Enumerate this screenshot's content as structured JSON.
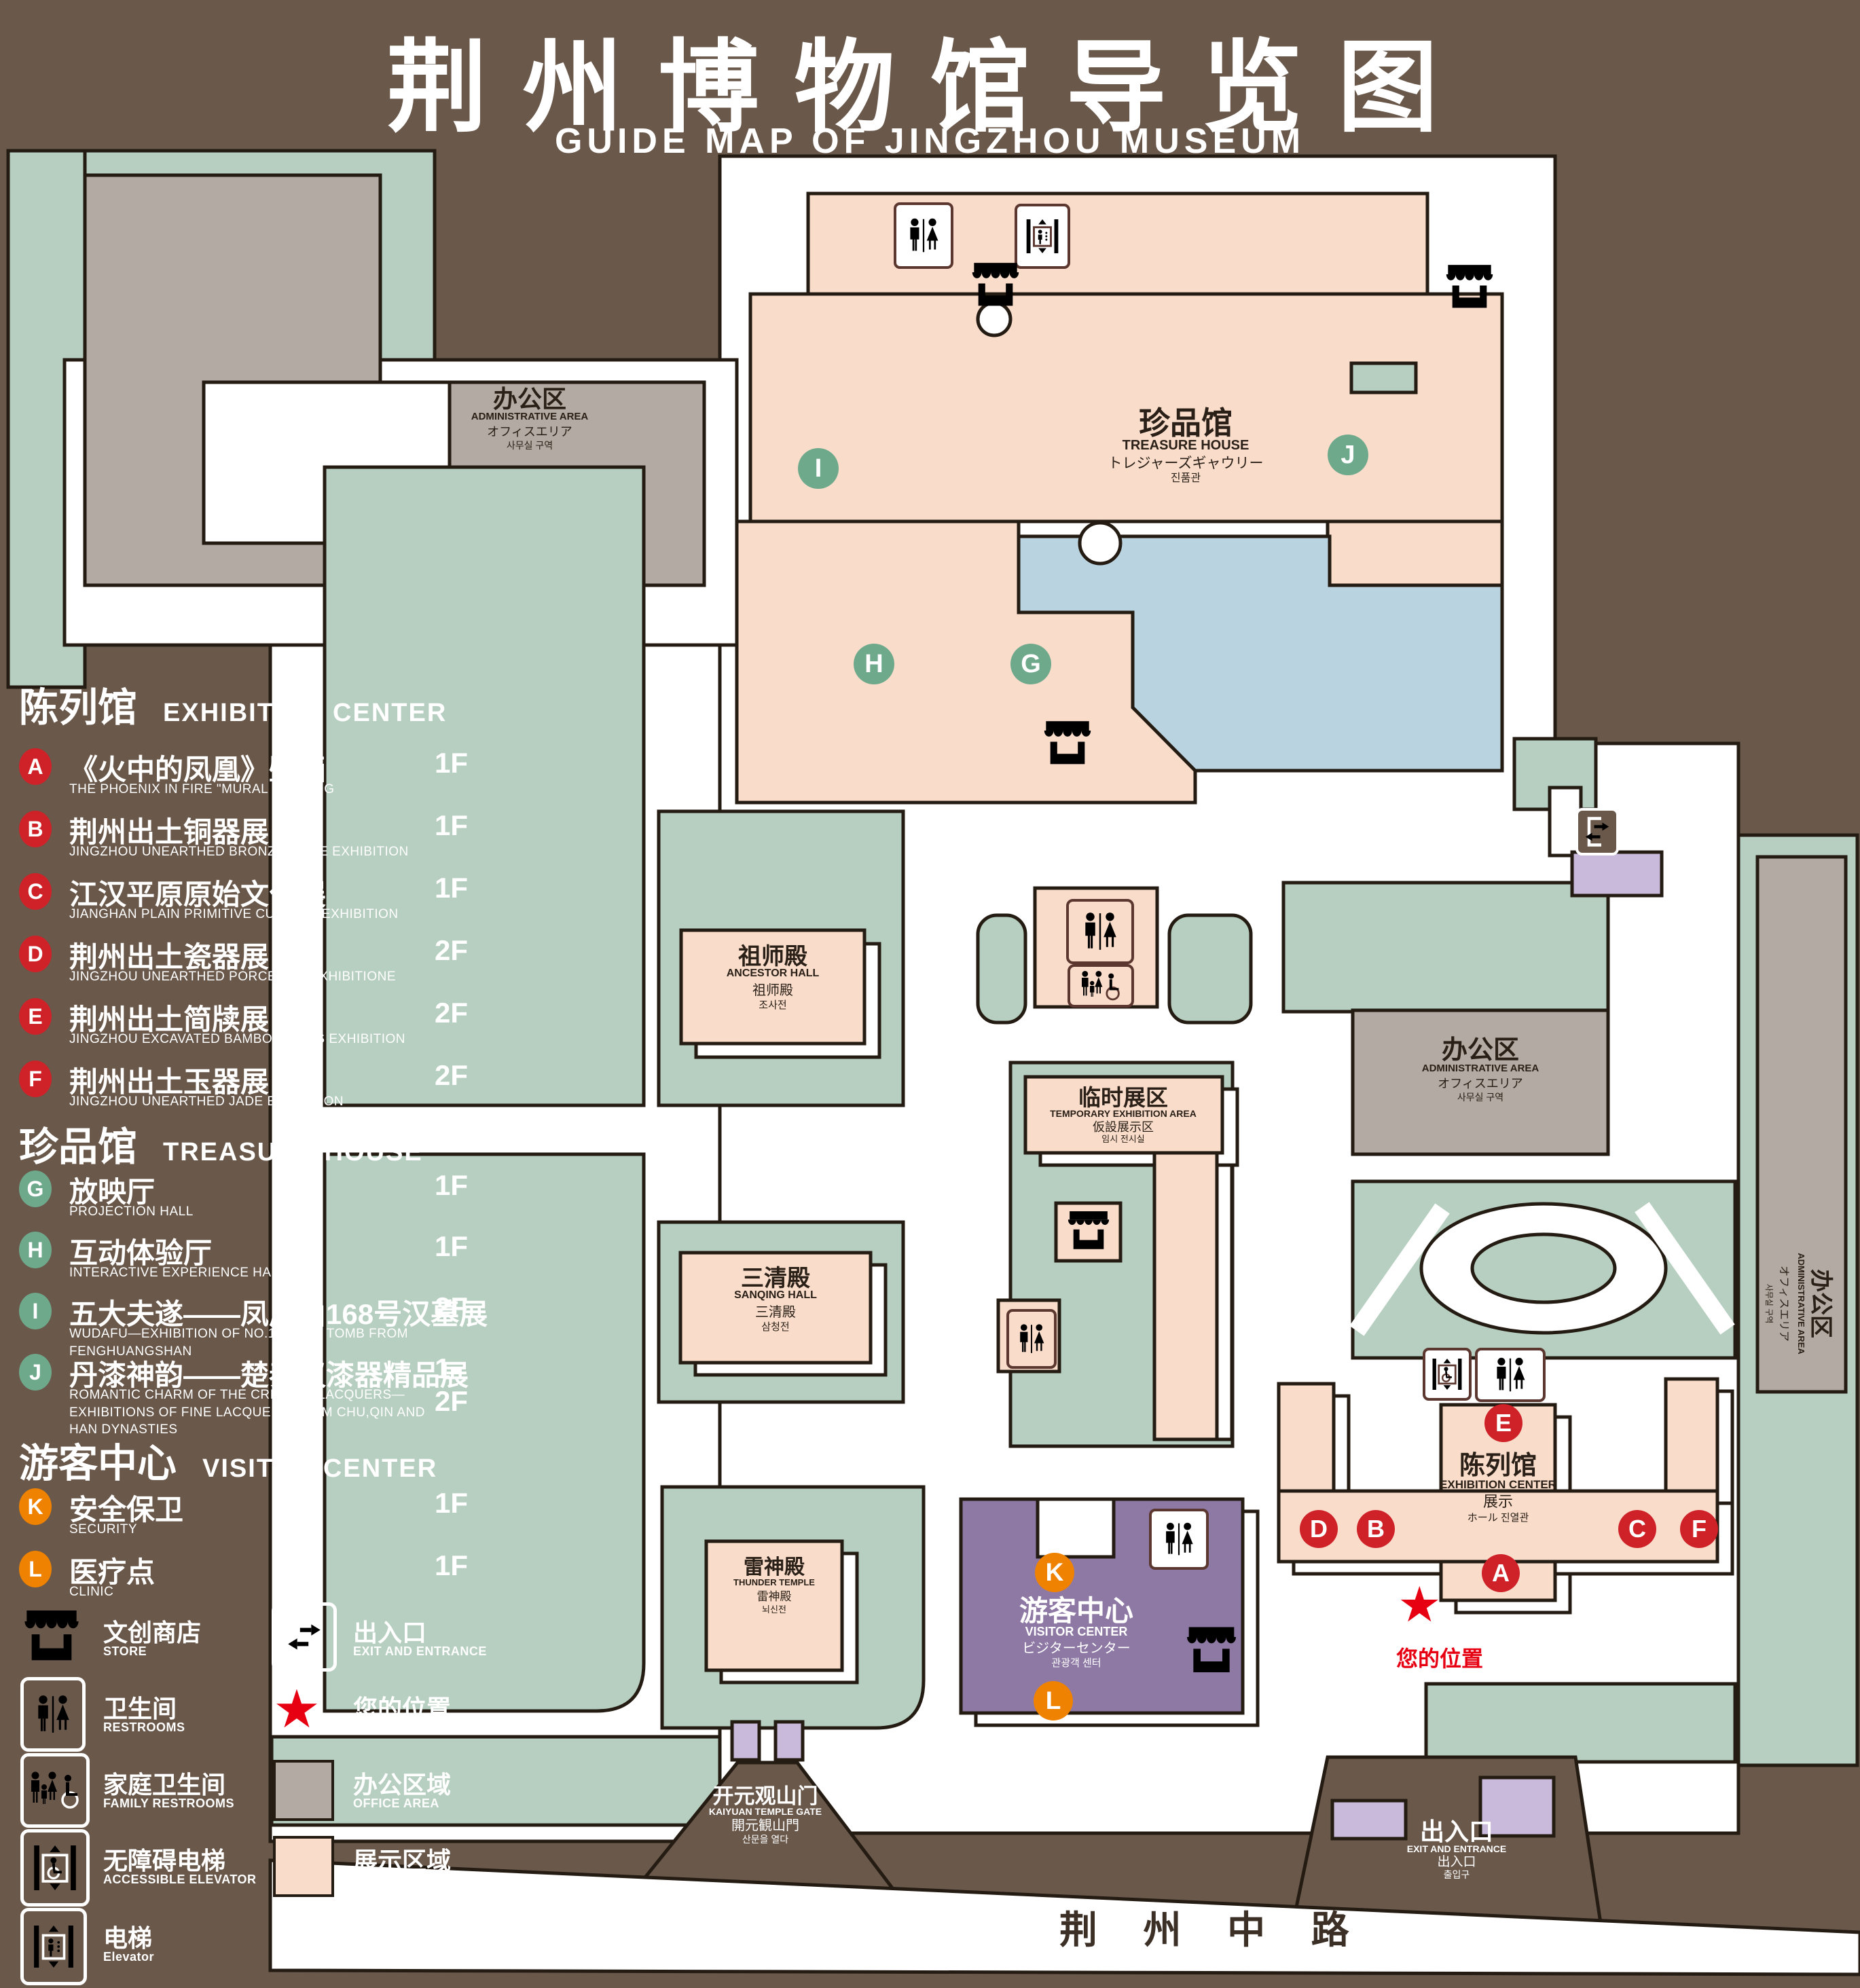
{
  "title": {
    "zh": "荆州博物馆导览图",
    "en": "GUIDE MAP OF JINGZHOU MUSEUM"
  },
  "colors": {
    "background": "#6a584b",
    "site_green": "#b7cfc0",
    "path_white": "#ffffff",
    "display_pink": "#f9dcca",
    "office_gray": "#b2aaa3",
    "pond_blue": "#b9d3e0",
    "visitor_purple": "#8e79a5",
    "entrance_purple": "#c9badb",
    "outline": "#241b13",
    "badge_red": "#cf2128",
    "badge_green": "#6fa98c",
    "badge_orange": "#ef8200",
    "location_red": "#e60012",
    "icon_brown": "#5c372f"
  },
  "sidebar": {
    "sections": [
      {
        "zh": "陈列馆",
        "en": "EXHIBITION CENTER",
        "items": [
          {
            "letter": "A",
            "zh": "《火中的凤凰》壁画",
            "en": "THE PHOENIX IN FIRE \"MURAL PAINTING",
            "floor": "1F"
          },
          {
            "letter": "B",
            "zh": "荆州出土铜器展",
            "en": "JINGZHOU UNEARTHED BRONZE WARE EXHIBITION",
            "floor": "1F"
          },
          {
            "letter": "C",
            "zh": "江汉平原原始文化展",
            "en": "JIANGHAN PLAIN PRIMITIVE CULTURE EXHIBITION",
            "floor": "1F"
          },
          {
            "letter": "D",
            "zh": "荆州出土瓷器展",
            "en": "JINGZHOU UNEARTHED PORCELAIN EXHIBITIONE",
            "floor": "2F"
          },
          {
            "letter": "E",
            "zh": "荆州出土简牍展",
            "en": "JINGZHOU EXCAVATED BAMBOO SLIPS EXHIBITION",
            "floor": "2F"
          },
          {
            "letter": "F",
            "zh": "荆州出土玉器展",
            "en": "JINGZHOU UNEARTHED JADE EXHIBITION",
            "floor": "2F"
          }
        ]
      },
      {
        "zh": "珍品馆",
        "en": "TREASURE HOUSE",
        "items": [
          {
            "letter": "G",
            "zh": "放映厅",
            "en": "PROJECTION HALL",
            "floor": "1F"
          },
          {
            "letter": "H",
            "zh": "互动体验厅",
            "en": "INTERACTIVE EXPERIENCE HALL",
            "floor": "1F"
          },
          {
            "letter": "I",
            "zh": "五大夫遂——凤凰山168号汉墓展",
            "en": "WUDAFU—EXHIBITION OF NO.168 HAN TOMB FROM FENGHUANGSHAN",
            "floor": "2F"
          },
          {
            "letter": "J",
            "zh": "丹漆神韵——楚秦汉漆器精品展",
            "en": "ROMANTIC CHARM OF THE CRIMSON LACQUERS—EXHIBITIONS OF FINE LACQUERS FROM CHU,QIN AND HAN DYNASTIES",
            "floor": "1-2F"
          }
        ]
      },
      {
        "zh": "游客中心",
        "en": "VISITOR CENTER",
        "items": [
          {
            "letter": "K",
            "zh": "安全保卫",
            "en": "SECURITY",
            "floor": "1F"
          },
          {
            "letter": "L",
            "zh": "医疗点",
            "en": "CLINIC",
            "floor": "1F"
          }
        ]
      }
    ],
    "legend": {
      "store": {
        "zh": "文创商店",
        "en": "STORE"
      },
      "exit": {
        "zh": "出入口",
        "en": "EXIT AND ENTRANCE"
      },
      "restrooms": {
        "zh": "卫生间",
        "en": "RESTROOMS"
      },
      "location": {
        "zh": "您的位置",
        "en": "YOUR LOCATION"
      },
      "family_restrooms": {
        "zh": "家庭卫生间",
        "en": "FAMILY RESTROOMS"
      },
      "office_area": {
        "zh": "办公区域",
        "en": "OFFICE AREA"
      },
      "accessible_elevator": {
        "zh": "无障碍电梯",
        "en": "ACCESSIBLE ELEVATOR"
      },
      "display_area": {
        "zh": "展示区域",
        "en": "DISPLAY AREA"
      },
      "elevator": {
        "zh": "电梯",
        "en": "Elevator"
      }
    }
  },
  "map": {
    "buildings": {
      "admin_nw": {
        "zh": "办公区",
        "en": "ADMINISTRATIVE AREA",
        "jp": "オフィスエリア",
        "kr": "사무실 구역"
      },
      "treasure_house": {
        "zh": "珍品馆",
        "en": "TREASURE HOUSE",
        "jp": "トレジャーズギャウリー",
        "kr": "진품관"
      },
      "ancestor_hall": {
        "zh": "祖师殿",
        "en": "ANCESTOR HALL",
        "jp": "祖师殿",
        "kr": "조사전"
      },
      "temporary_area": {
        "zh": "临时展区",
        "en": "TEMPORARY EXHIBITION AREA",
        "jp": "仮設展示区",
        "kr": "임시 전시실"
      },
      "sanqing_hall": {
        "zh": "三清殿",
        "en": "SANQING HALL",
        "jp": "三清殿",
        "kr": "삼청전"
      },
      "thunder_temple": {
        "zh": "雷神殿",
        "en": "THUNDER TEMPLE",
        "jp": "雷神殿",
        "kr": "뇌신전"
      },
      "visitor_center": {
        "zh": "游客中心",
        "en": "VISITOR CENTER",
        "jp": "ビジターセンター",
        "kr": "관광객 센터"
      },
      "exhibition_center": {
        "zh": "陈列馆",
        "en": "EXHIBITION CENTER",
        "jp": "展示",
        "kr": "ホール 진열관"
      },
      "admin_mid": {
        "zh": "办公区",
        "en": "ADMINISTRATIVE AREA",
        "jp": "オフィスエリア",
        "kr": "사무실 구역"
      },
      "admin_east": {
        "zh": "办公区",
        "en": "ADMINISTRATIVE AREA",
        "jp": "オフィスエリア",
        "kr": "사무실 구역"
      },
      "gate": {
        "zh": "开元观山门",
        "en": "KAIYUAN TEMPLE GATE",
        "jp": "開元観山門",
        "kr": "산문을 열다"
      },
      "exit_ne": {
        "zh": "出入口",
        "en": "EXIT AND ENTRANCE",
        "jp": "出入口",
        "kr": "출입구"
      },
      "exit_se": {
        "zh": "出入口",
        "en": "EXIT AND ENTRANCE",
        "jp": "出入口",
        "kr": "출입구"
      }
    },
    "road": "荆 州 中 路",
    "your_location": "您的位置",
    "markers": {
      "a": "A",
      "b": "B",
      "c": "C",
      "d": "D",
      "e": "E",
      "f": "F",
      "g": "G",
      "h": "H",
      "i": "I",
      "j": "J",
      "k": "K",
      "l": "L"
    }
  }
}
